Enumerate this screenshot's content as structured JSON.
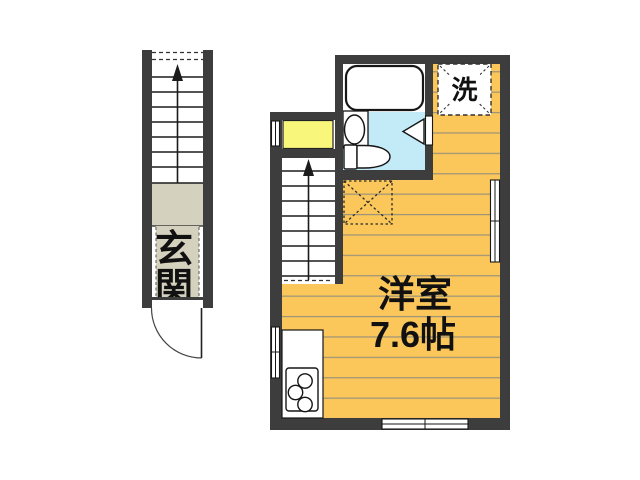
{
  "plan": {
    "room": {
      "name": "洋室",
      "size": "7.6帖"
    },
    "entrance": {
      "chars": [
        "玄",
        "関"
      ]
    },
    "washer": {
      "label": "洗"
    }
  },
  "colors": {
    "wall": "#3d3d3d",
    "floor": "#FBC75B",
    "plank_line": "#9e9478",
    "genkan": "#D5D1BF",
    "closet": "#F9F67C",
    "bath_floor": "#C3EBF7"
  }
}
